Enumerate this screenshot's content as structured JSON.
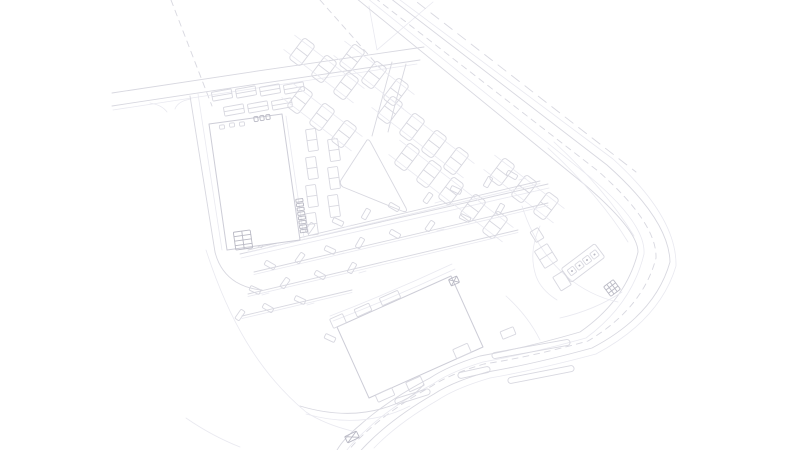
{
  "document": {
    "kind": "site-plan line drawing",
    "background": "#ffffff"
  },
  "palette": {
    "line": "#d8d8e0",
    "faint": "#e9e9f0",
    "dark": "#b9b9c4",
    "building": "#cdcdd7",
    "fill": "#ffffff"
  },
  "drawing": {
    "canvas": {
      "width": 800,
      "height": 450
    },
    "layers": {
      "property-lines": {
        "paths": [
          {
            "d": "M 171,0 L 212,106",
            "cls": "ln dash"
          },
          {
            "d": "M 320,0 L 381,69",
            "cls": "ln dash"
          },
          {
            "d": "M 369,6 L 377,50 L 433,2",
            "cls": "lnf"
          }
        ]
      },
      "main-road": {
        "paths": [
          {
            "d": "M 351,-6 L 584,184 Q 638,230 638,252 Q 626,300 580,332 Q 525,348 480,356 Q 448,366 430,378 Q 388,400 360,425 Q 342,440 336,452",
            "cls": "ln"
          },
          {
            "d": "M 357,-10 L 590,177 Q 646,224 644,254 Q 632,304 586,338 Q 528,354 483,362 Q 450,372 433,384 Q 391,406 364,432 Q 348,446 342,458",
            "cls": "lnf"
          },
          {
            "d": "M 377,-12 L 607,165 Q 669,220 670,262 Q 655,315 592,348 Q 534,364 487,372 Q 452,382 434,394 Q 394,417 368,443 Q 356,455 352,462",
            "cls": "ln"
          },
          {
            "d": "M 384,-12 L 613,159 Q 677,217 676,266 Q 660,320 596,354 Q 536,370 490,378 Q 456,388 438,400 Q 398,423 374,448",
            "cls": "lnf"
          },
          {
            "d": "M 366,-9 L 598,171 Q 657,223 656,258 Q 643,308 588,341 Q 530,357 484,364 Q 450,374 432,386 Q 392,408 364,434 Q 350,447 344,457",
            "cls": "ln dash"
          },
          {
            "d": "M 404,-8 L 636,172",
            "cls": "ln dash2"
          },
          {
            "d": "M 548,148 Q 600,196 628,242",
            "cls": "lnf"
          },
          {
            "d": "M 554,142 Q 606,190 634,236",
            "cls": "lnf"
          }
        ]
      },
      "access-road": {
        "paths": [
          {
            "d": "M 112,93 C 210,78 330,60 424,47",
            "cls": "ln"
          },
          {
            "d": "M 112,106 C 210,91 330,73 420,60",
            "cls": "ln"
          },
          {
            "d": "M 113,110 C 210,95 330,77 417,64",
            "cls": "lnf"
          },
          {
            "d": "M 150,103 Q 162,105 167,112",
            "cls": "lnf"
          },
          {
            "d": "M 191,99 Q 178,101 175,109",
            "cls": "lnf"
          },
          {
            "d": "M 392,62 L 372,136",
            "cls": "ln"
          },
          {
            "d": "M 406,64 Q 396,100 388,132",
            "cls": "ln"
          }
        ]
      },
      "service-drives": {
        "paths": [
          {
            "d": "M 190,96 L 215,252",
            "cls": "ln"
          },
          {
            "d": "M 198,94 L 222,250",
            "cls": "lnf"
          },
          {
            "d": "M 215,252 Q 220,272 236,282 Q 248,289 262,290",
            "cls": "ln"
          },
          {
            "d": "M 240,254 L 548,184",
            "cls": "ln"
          },
          {
            "d": "M 241,258 L 549,188",
            "cls": "lnf"
          },
          {
            "d": "M 330,316 Q 392,292 452,264",
            "cls": "lnf"
          },
          {
            "d": "M 333,321 Q 395,297 455,269",
            "cls": "lnf"
          },
          {
            "d": "M 300,406 Q 360,424 408,398 Q 418,392 424,384",
            "cls": "ln"
          },
          {
            "d": "M 306,414 Q 362,430 410,406",
            "cls": "lnf"
          },
          {
            "d": "M 206,250 C 228,318 258,372 306,412 Q 324,424 352,431",
            "cls": "lnf"
          },
          {
            "d": "M 186,418 Q 212,436 240,447",
            "cls": "lnf"
          },
          {
            "d": "M 506,296 Q 528,316 540,340",
            "cls": "lnf"
          },
          {
            "d": "M 622,292 Q 595,310 560,318",
            "cls": "lnf"
          }
        ],
        "rects": [
          {
            "x": 352,
            "y": 437,
            "w": 13,
            "h": 7,
            "a": -26,
            "cls": "lnd",
            "cross": true
          }
        ]
      },
      "retail-building": {
        "polys": [
          {
            "points": "209,124 282,114 300,240 227,250",
            "cls": "bld"
          }
        ],
        "paths": [
          {
            "d": "M 233,232 L 296,223",
            "cls": "lnf"
          },
          {
            "d": "M 286,116 L 304,238",
            "cls": "lnf"
          }
        ],
        "rects": [
          {
            "x": 222,
            "y": 127,
            "w": 5,
            "h": 4,
            "a": -8,
            "cls": "ln"
          },
          {
            "x": 232,
            "y": 125,
            "w": 5,
            "h": 4,
            "a": -8,
            "cls": "ln"
          },
          {
            "x": 242,
            "y": 124,
            "w": 5,
            "h": 4,
            "a": -8,
            "cls": "ln"
          },
          {
            "x": 256,
            "y": 119,
            "w": 4,
            "h": 5,
            "a": -8,
            "cls": "lnd"
          },
          {
            "x": 262,
            "y": 118,
            "w": 4,
            "h": 5,
            "a": -8,
            "cls": "lnd"
          },
          {
            "x": 268,
            "y": 117,
            "w": 4,
            "h": 5,
            "a": -8,
            "cls": "lnd"
          },
          {
            "x": 243,
            "y": 240,
            "w": 17,
            "h": 18,
            "a": -8,
            "cls": "lnd",
            "grid": [
              2,
              4
            ]
          }
        ],
        "ticks": {
          "x0": 282,
          "y0": 114,
          "ux": 0.141,
          "uy": 0.99,
          "t0": 88,
          "t1": 123,
          "step": 4.4,
          "ox": 5,
          "oy": -0.7,
          "w": 7,
          "h": 3,
          "a": -8,
          "cls": "lnd"
        }
      },
      "anchor-store": {
        "polys": [
          {
            "points": "337,327 451,276 483,347 369,398",
            "cls": "bld"
          }
        ],
        "paths": [
          {
            "d": "M 429,286 L 461,357",
            "cls": "lnf"
          }
        ],
        "rects": [
          {
            "x": 363,
            "y": 310,
            "w": 16,
            "h": 8,
            "a": -24,
            "cls": "ln"
          },
          {
            "x": 390,
            "y": 298,
            "w": 20,
            "h": 8,
            "a": -24,
            "cls": "ln"
          },
          {
            "x": 338,
            "y": 321,
            "w": 14,
            "h": 10,
            "a": -24,
            "cls": "ln"
          },
          {
            "x": 385,
            "y": 395,
            "w": 18,
            "h": 8,
            "a": -24,
            "cls": "ln"
          },
          {
            "x": 415,
            "y": 384,
            "w": 16,
            "h": 10,
            "a": -24,
            "cls": "ln"
          },
          {
            "x": 462,
            "y": 351,
            "w": 16,
            "h": 10,
            "a": -24,
            "cls": "ln"
          },
          {
            "x": 454,
            "y": 281,
            "w": 9,
            "h": 7,
            "a": -24,
            "cls": "lnd",
            "cross": true
          },
          {
            "x": 508,
            "y": 333,
            "w": 14,
            "h": 8,
            "a": -22,
            "cls": "ln"
          }
        ]
      },
      "parking-north": {
        "chains": [
          {
            "x": 302,
            "y": 52,
            "n": 3
          },
          {
            "x": 300,
            "y": 100,
            "n": 3
          },
          {
            "x": 352,
            "y": 58,
            "n": 3
          },
          {
            "x": 390,
            "y": 110,
            "n": 4
          },
          {
            "x": 407,
            "y": 157,
            "n": 5
          },
          {
            "x": 502,
            "y": 172,
            "n": 3
          }
        ],
        "module": {
          "w": 14,
          "h": 26,
          "a": 37,
          "dx": 22,
          "dy": 17,
          "rx": 3
        },
        "rects": [
          {
            "x": 222,
            "y": 95,
            "w": 20,
            "h": 9,
            "a": -10,
            "cls": "ln",
            "divider": true
          },
          {
            "x": 246,
            "y": 92,
            "w": 20,
            "h": 9,
            "a": -10,
            "cls": "ln",
            "divider": true
          },
          {
            "x": 270,
            "y": 90,
            "w": 20,
            "h": 9,
            "a": -10,
            "cls": "ln",
            "divider": true
          },
          {
            "x": 294,
            "y": 88,
            "w": 20,
            "h": 9,
            "a": -10,
            "cls": "ln",
            "divider": true
          },
          {
            "x": 234,
            "y": 110,
            "w": 20,
            "h": 9,
            "a": -10,
            "cls": "ln",
            "divider": true
          },
          {
            "x": 258,
            "y": 107,
            "w": 20,
            "h": 9,
            "a": -10,
            "cls": "ln",
            "divider": true
          },
          {
            "x": 282,
            "y": 104,
            "w": 20,
            "h": 9,
            "a": -10,
            "cls": "ln",
            "divider": true
          },
          {
            "x": 312,
            "y": 140,
            "w": 10,
            "h": 22,
            "a": -8,
            "cls": "ln",
            "divider": true
          },
          {
            "x": 312,
            "y": 168,
            "w": 10,
            "h": 22,
            "a": -8,
            "cls": "ln",
            "divider": true
          },
          {
            "x": 312,
            "y": 196,
            "w": 10,
            "h": 22,
            "a": -8,
            "cls": "ln",
            "divider": true
          },
          {
            "x": 312,
            "y": 224,
            "w": 10,
            "h": 22,
            "a": -8,
            "cls": "ln",
            "divider": true
          },
          {
            "x": 334,
            "y": 150,
            "w": 10,
            "h": 22,
            "a": -8,
            "cls": "ln",
            "divider": true
          },
          {
            "x": 334,
            "y": 178,
            "w": 10,
            "h": 22,
            "a": -8,
            "cls": "ln",
            "divider": true
          },
          {
            "x": 334,
            "y": 206,
            "w": 10,
            "h": 22,
            "a": -8,
            "cls": "ln",
            "divider": true
          }
        ],
        "island": {
          "d": "M 367,140 L 341,180 Q 339,184 343,187 L 402,211 Q 408,213 406,208 L 371,143 Q 369,139 367,140 Z",
          "cls": "wfill"
        }
      },
      "parking-south": {
        "rows": [
          [
            248,
            250,
            540,
            181
          ],
          [
            254,
            272,
            548,
            203
          ],
          [
            248,
            294,
            518,
            230
          ],
          [
            242,
            316,
            352,
            290
          ]
        ],
        "car": {
          "w": 11,
          "h": 5,
          "rx": 1.2
        },
        "cars": [
          [
            262,
            242,
            -60
          ],
          [
            285,
            236,
            30
          ],
          [
            310,
            228,
            -55
          ],
          [
            338,
            222,
            25
          ],
          [
            366,
            214,
            -60
          ],
          [
            394,
            207,
            30
          ],
          [
            428,
            198,
            -55
          ],
          [
            456,
            190,
            25
          ],
          [
            488,
            182,
            -60
          ],
          [
            512,
            175,
            30
          ],
          [
            270,
            265,
            30
          ],
          [
            300,
            258,
            -55
          ],
          [
            330,
            250,
            25
          ],
          [
            360,
            243,
            -60
          ],
          [
            395,
            234,
            30
          ],
          [
            430,
            226,
            -55
          ],
          [
            465,
            218,
            25
          ],
          [
            500,
            209,
            -60
          ],
          [
            255,
            290,
            25
          ],
          [
            285,
            283,
            -55
          ],
          [
            320,
            275,
            30
          ],
          [
            352,
            268,
            -60
          ],
          [
            240,
            315,
            -55
          ],
          [
            268,
            308,
            30
          ],
          [
            300,
            300,
            25
          ],
          [
            330,
            338,
            25
          ]
        ]
      },
      "gas-station": {
        "rects": [
          {
            "x": 583,
            "y": 263,
            "w": 42,
            "h": 17,
            "a": -37,
            "cls": "ln",
            "rx": 2
          },
          {
            "x": 572,
            "y": 271,
            "w": 7,
            "h": 7,
            "a": -37,
            "cls": "ln",
            "dot": true
          },
          {
            "x": 579.5,
            "y": 265.5,
            "w": 7,
            "h": 7,
            "a": -37,
            "cls": "ln",
            "dot": true
          },
          {
            "x": 587,
            "y": 260,
            "w": 7,
            "h": 7,
            "a": -37,
            "cls": "ln",
            "dot": true
          },
          {
            "x": 594.5,
            "y": 254.5,
            "w": 7,
            "h": 7,
            "a": -37,
            "cls": "ln",
            "dot": true
          },
          {
            "x": 546,
            "y": 256,
            "w": 15,
            "h": 20,
            "a": -32,
            "cls": "ln",
            "divider": true
          },
          {
            "x": 562,
            "y": 281,
            "w": 12,
            "h": 16,
            "a": -32,
            "cls": "ln"
          },
          {
            "x": 537,
            "y": 235,
            "w": 9,
            "h": 12,
            "a": -32,
            "cls": "ln"
          },
          {
            "x": 612,
            "y": 288,
            "w": 12,
            "h": 12,
            "a": -37,
            "cls": "lnd",
            "grid": [
              3,
              3
            ]
          }
        ],
        "paths": [
          {
            "d": "M 522,206 Q 536,250 566,276 Q 590,296 618,302",
            "cls": "lnf"
          },
          {
            "d": "M 540,226 Q 528,252 536,276 Q 541,290 557,300",
            "cls": "lnf"
          }
        ]
      },
      "boulevard-medians": {
        "capsules": [
          [
            492,
            356,
            570,
            342
          ],
          [
            508,
            381,
            574,
            368
          ],
          [
            458,
            376,
            490,
            369
          ],
          [
            395,
            402,
            430,
            391
          ]
        ],
        "width": 6
      }
    }
  }
}
